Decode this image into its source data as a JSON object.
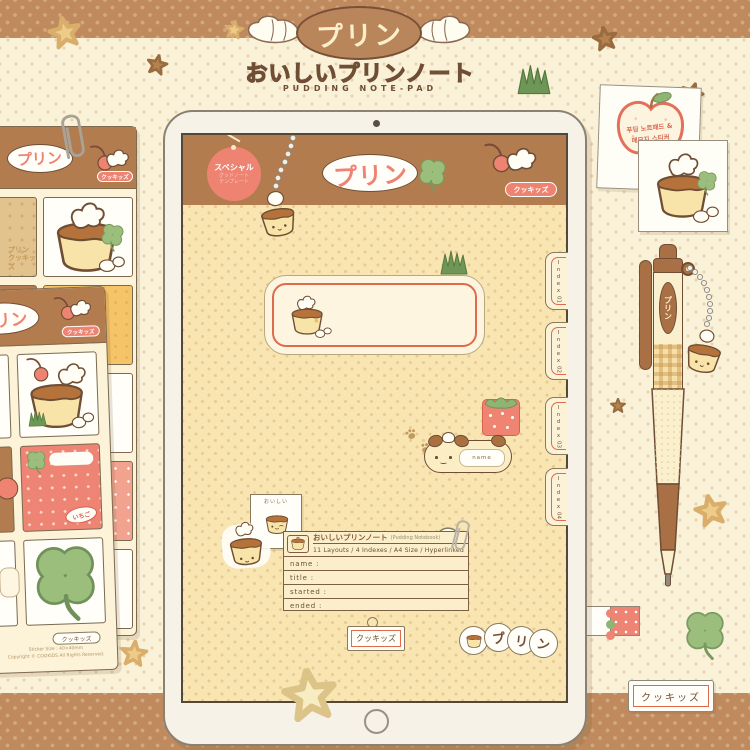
{
  "header": {
    "badge": "プリン",
    "subtitle_jp": "おいしいプリンノート",
    "subtitle_en": "PUDDING NOTE-PAD"
  },
  "tablet": {
    "special_tag": {
      "line1": "スペシャル",
      "line2": "グッドノート",
      "line3": "テンプレート"
    },
    "logo": "プリン",
    "brand_badge": "クッキッズ",
    "index_tabs": [
      {
        "word": "Index",
        "num": "01"
      },
      {
        "word": "Index",
        "num": "02"
      },
      {
        "word": "Index",
        "num": "03"
      },
      {
        "word": "Index",
        "num": "04"
      }
    ],
    "name_tag": "name",
    "mini_card": "おいしい",
    "info_card": {
      "title_jp": "おいしいプリンノート",
      "title_en": "(Pudding Notebook)",
      "specs": "11 Layouts / 4 Indexes / A4 Size / Hyperlinked",
      "fields": [
        "name :",
        "title :",
        "started :",
        "ended :"
      ]
    },
    "bottom_tag": "クッキッズ",
    "bubbles": [
      "プ",
      "リ",
      "ン"
    ]
  },
  "sheet1": {
    "logo": "プリン",
    "brand": "クッキッズ",
    "watermark_1": "プリン",
    "watermark_2": "クッキッズ"
  },
  "sheet2": {
    "logo": "プリン",
    "brand": "クッキッズ",
    "strawberry_badge": "いちご",
    "footer_badge": "クッキッズ",
    "footer_line1": "Sticker Size : 40×40mm",
    "footer_line2": "Copyright © COOKIDS All Rights Reserved."
  },
  "memo_notes": {
    "apple_line1": "푸딩 노트패드 &",
    "apple_line2": "메모지 스티커"
  },
  "pen": {
    "label": "プリン"
  },
  "bottom_right_label": "クッキッズ",
  "colors": {
    "accent_salmon": "#EE8372",
    "header_brown": "#B27C4F",
    "cream": "#FAF2D8",
    "red_border": "#DF6A4C",
    "clover_green": "#9CBE7C",
    "outline_brown": "#6F4E35"
  }
}
